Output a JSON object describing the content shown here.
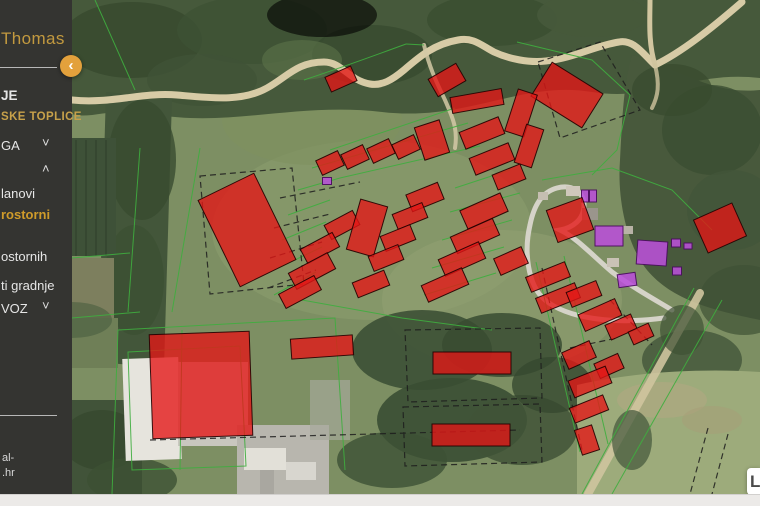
{
  "sidebar": {
    "logo_text": "Thomas",
    "items": [
      {
        "label": "JE",
        "style": "section",
        "chevron": ""
      },
      {
        "label": "SKE TOPLICE",
        "style": "gold",
        "chevron": ""
      },
      {
        "label": "GA",
        "style": "normal",
        "chevron": "down"
      },
      {
        "label": "",
        "style": "normal",
        "chevron": "up"
      },
      {
        "label": "lanovi",
        "style": "normal",
        "chevron": ""
      },
      {
        "label": "rostorni",
        "style": "active-orange",
        "chevron": ""
      },
      {
        "label": "ostornih",
        "style": "normal",
        "chevron": ""
      },
      {
        "label": "ti gradnje",
        "style": "normal",
        "chevron": ""
      },
      {
        "label": "VOZ",
        "style": "normal",
        "chevron": "down"
      }
    ],
    "footer_lines": [
      "al-",
      ".hr"
    ],
    "collapse_button_glyph": "‹"
  },
  "icons": {
    "chevron_down": "˅",
    "chevron_up": "˄"
  },
  "map": {
    "attribution": "L",
    "red_buildings": [
      [
        269,
        79,
        28,
        16,
        -24
      ],
      [
        375,
        80,
        32,
        20,
        -30
      ],
      [
        495,
        95,
        60,
        40,
        32
      ],
      [
        405,
        101,
        52,
        16,
        -10
      ],
      [
        449,
        113,
        20,
        44,
        18
      ],
      [
        457,
        146,
        18,
        40,
        18
      ],
      [
        258,
        163,
        24,
        16,
        -25
      ],
      [
        283,
        157,
        24,
        16,
        -25
      ],
      [
        309,
        151,
        24,
        16,
        -25
      ],
      [
        334,
        147,
        24,
        16,
        -25
      ],
      [
        360,
        140,
        26,
        34,
        -18
      ],
      [
        410,
        133,
        42,
        18,
        -22
      ],
      [
        420,
        159,
        42,
        18,
        -22
      ],
      [
        437,
        177,
        30,
        16,
        -22
      ],
      [
        175,
        230,
        62,
        96,
        -26
      ],
      [
        270,
        225,
        32,
        16,
        -28
      ],
      [
        248,
        248,
        36,
        16,
        -28
      ],
      [
        240,
        271,
        44,
        18,
        -28
      ],
      [
        228,
        292,
        40,
        16,
        -28
      ],
      [
        295,
        228,
        28,
        52,
        16
      ],
      [
        353,
        197,
        34,
        18,
        -22
      ],
      [
        338,
        216,
        32,
        16,
        -22
      ],
      [
        326,
        238,
        32,
        16,
        -22
      ],
      [
        314,
        258,
        32,
        16,
        -22
      ],
      [
        299,
        284,
        34,
        16,
        -22
      ],
      [
        412,
        211,
        44,
        20,
        -24
      ],
      [
        403,
        236,
        46,
        18,
        -24
      ],
      [
        390,
        259,
        44,
        18,
        -24
      ],
      [
        373,
        285,
        44,
        18,
        -24
      ],
      [
        439,
        261,
        30,
        18,
        -24
      ],
      [
        498,
        220,
        38,
        34,
        -20
      ],
      [
        648,
        228,
        42,
        36,
        -24
      ],
      [
        476,
        277,
        42,
        16,
        -22
      ],
      [
        486,
        298,
        42,
        16,
        -22
      ],
      [
        512,
        294,
        32,
        16,
        -22
      ],
      [
        528,
        315,
        40,
        18,
        -24
      ],
      [
        549,
        327,
        28,
        16,
        -24
      ],
      [
        569,
        334,
        22,
        14,
        -24
      ],
      [
        507,
        355,
        30,
        18,
        -24
      ],
      [
        537,
        366,
        26,
        16,
        -24
      ],
      [
        518,
        382,
        40,
        18,
        -22
      ],
      [
        517,
        409,
        36,
        16,
        -22
      ],
      [
        515,
        440,
        18,
        26,
        -18
      ],
      [
        400,
        363,
        78,
        22,
        0
      ],
      [
        399,
        435,
        78,
        22,
        0
      ],
      [
        129,
        385,
        100,
        104,
        -2
      ],
      [
        250,
        347,
        62,
        20,
        -4
      ]
    ],
    "purple_buildings": [
      [
        255,
        181,
        9,
        7,
        0
      ],
      [
        513,
        196,
        7,
        12,
        0
      ],
      [
        521,
        196,
        7,
        12,
        0
      ],
      [
        537,
        236,
        28,
        20,
        0
      ],
      [
        580,
        253,
        30,
        24,
        4
      ],
      [
        555,
        280,
        18,
        13,
        -8
      ],
      [
        604,
        243,
        9,
        8,
        0
      ],
      [
        616,
        246,
        8,
        6,
        0
      ],
      [
        605,
        271,
        9,
        8,
        0
      ]
    ]
  },
  "colors": {
    "illegal_fill": "rgba(228,22,22,0.78)",
    "illegal_stroke": "rgba(35,0,0,0.9)",
    "legal_fill": "rgba(185,80,216,0.88)",
    "legal_stroke": "rgba(70,10,90,0.9)",
    "parcel_line": "#3fae3f",
    "sidebar_bg": "#343431",
    "accent_gold": "#c7a14a",
    "button_orange": "#e3a13c"
  }
}
